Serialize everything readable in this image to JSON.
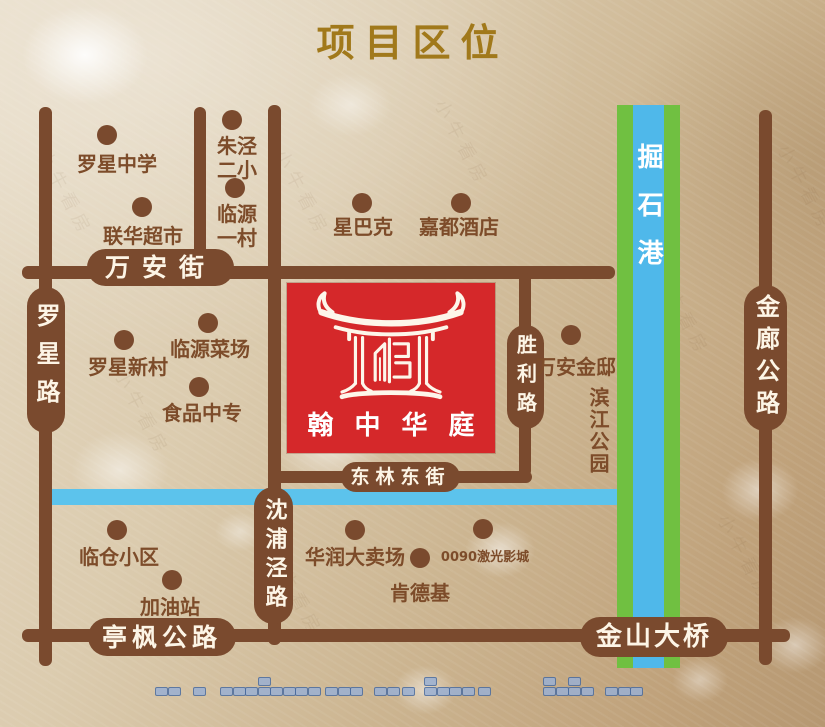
{
  "title": "项目区位",
  "colors": {
    "road": "#7a4a2e",
    "label_text": "#7d4c2a",
    "title_gold": "#a1791b",
    "capsule_text": "#fdf5e6",
    "red_block": "#d5282a",
    "river_green": "#70c041",
    "river_blue": "#4fb8ea",
    "canal_blue": "#5cc3ec",
    "dash_fill": "#9ab0d3",
    "dash_border": "#4a6ca0"
  },
  "project": {
    "name": "翰中华庭",
    "display": "翰中华庭",
    "block": {
      "x": 287,
      "y": 283,
      "w": 208,
      "h": 170
    }
  },
  "roads": [
    {
      "id": "wanan-street-line",
      "type": "h",
      "x": 22,
      "y": 266,
      "len": 593,
      "th": 13
    },
    {
      "id": "donglin-east-street-line",
      "type": "h",
      "x": 268,
      "y": 471,
      "len": 264,
      "th": 12
    },
    {
      "id": "tingfeng-jinshan-line",
      "type": "h",
      "x": 22,
      "y": 629,
      "len": 768,
      "th": 13
    },
    {
      "id": "luoxing-road-line",
      "type": "v",
      "x": 39,
      "y": 107,
      "len": 559,
      "th": 13
    },
    {
      "id": "north-branch-line",
      "type": "v",
      "x": 194,
      "y": 107,
      "len": 166,
      "th": 12
    },
    {
      "id": "shenpujing-road-line",
      "type": "v",
      "x": 268,
      "y": 105,
      "len": 540,
      "th": 13
    },
    {
      "id": "shengli-road-line",
      "type": "v",
      "x": 519,
      "y": 273,
      "len": 204,
      "th": 12
    },
    {
      "id": "jinlang-road-line",
      "type": "v",
      "x": 759,
      "y": 110,
      "len": 555,
      "th": 13
    }
  ],
  "road_labels": [
    {
      "id": "wanan-street",
      "text": "万安街",
      "dir": "h",
      "x": 87,
      "y": 249,
      "w": 147,
      "h": 37,
      "fs": 25,
      "ls": 12
    },
    {
      "id": "donglin-east-street",
      "text": "东林东街",
      "dir": "h",
      "x": 341,
      "y": 462,
      "w": 119,
      "h": 30,
      "fs": 19,
      "ls": 6
    },
    {
      "id": "tingfeng-highway",
      "text": "亭枫公路",
      "dir": "h",
      "x": 88,
      "y": 618,
      "w": 148,
      "h": 38,
      "fs": 25,
      "ls": 5
    },
    {
      "id": "jinshan-bridge",
      "text": "金山大桥",
      "dir": "h",
      "x": 580,
      "y": 617,
      "w": 148,
      "h": 40,
      "fs": 26,
      "ls": 3
    },
    {
      "id": "luoxing-road",
      "text": "罗星路",
      "dir": "v",
      "x": 27,
      "y": 287,
      "w": 38,
      "h": 146,
      "fs": 24,
      "ls": 14
    },
    {
      "id": "shenpujing-road",
      "text": "沈浦泾路",
      "dir": "v",
      "x": 254,
      "y": 487,
      "w": 39,
      "h": 137,
      "fs": 22,
      "ls": 7
    },
    {
      "id": "shengli-road",
      "text": "胜利路",
      "dir": "v",
      "x": 507,
      "y": 325,
      "w": 37,
      "h": 104,
      "fs": 20,
      "ls": 9
    },
    {
      "id": "jinlang-highway",
      "text": "金廊公路",
      "dir": "v",
      "x": 744,
      "y": 285,
      "w": 43,
      "h": 146,
      "fs": 24,
      "ls": 8
    }
  ],
  "rivers": {
    "vertical": {
      "name": "掘石港",
      "x": 617,
      "y": 105,
      "w": 63,
      "h": 563,
      "green_w": 16
    },
    "canal": {
      "x": 45,
      "y": 489,
      "w": 572,
      "h": 16
    }
  },
  "pois": [
    {
      "id": "luoxing-middle-school",
      "lines": [
        "罗星中学"
      ],
      "dot": [
        107,
        135
      ],
      "label": [
        117,
        164
      ],
      "fs": 20
    },
    {
      "id": "lianhua-supermarket",
      "lines": [
        "联华超市"
      ],
      "dot": [
        142,
        207
      ],
      "label": [
        143,
        236
      ],
      "fs": 20
    },
    {
      "id": "zhujing-no2-primary",
      "lines": [
        "朱泾",
        "二小"
      ],
      "dot": [
        232,
        120
      ],
      "label": [
        237,
        158
      ],
      "fs": 20
    },
    {
      "id": "linyuan-village-1",
      "lines": [
        "临源",
        "一村"
      ],
      "dot": [
        235,
        188
      ],
      "label": [
        237,
        226
      ],
      "fs": 20
    },
    {
      "id": "starbucks",
      "lines": [
        "星巴克"
      ],
      "dot": [
        362,
        203
      ],
      "label": [
        363,
        227
      ],
      "fs": 20
    },
    {
      "id": "jiadu-hotel",
      "lines": [
        "嘉都酒店"
      ],
      "dot": [
        461,
        203
      ],
      "label": [
        459,
        227
      ],
      "fs": 20
    },
    {
      "id": "linyuan-market",
      "lines": [
        "临源菜场"
      ],
      "dot": [
        208,
        323
      ],
      "label": [
        210,
        349
      ],
      "fs": 20
    },
    {
      "id": "luoxing-new-village",
      "lines": [
        "罗星新村"
      ],
      "dot": [
        124,
        340
      ],
      "label": [
        128,
        367
      ],
      "fs": 20
    },
    {
      "id": "food-vocational-school",
      "lines": [
        "食品中专"
      ],
      "dot": [
        199,
        387
      ],
      "label": [
        202,
        413
      ],
      "fs": 20
    },
    {
      "id": "wanan-jindi",
      "lines": [
        "万安金邸"
      ],
      "dot": [
        571,
        335
      ],
      "label": [
        576,
        367
      ],
      "fs": 20
    },
    {
      "id": "lincang-residence",
      "lines": [
        "临仓小区"
      ],
      "dot": [
        117,
        530
      ],
      "label": [
        119,
        557
      ],
      "fs": 20
    },
    {
      "id": "gas-station",
      "lines": [
        "加油站"
      ],
      "dot": [
        172,
        580
      ],
      "label": [
        170,
        607
      ],
      "fs": 20
    },
    {
      "id": "huarun-hypermarket",
      "lines": [
        "华润大卖场"
      ],
      "dot": [
        355,
        530
      ],
      "label": [
        355,
        557
      ],
      "fs": 20
    },
    {
      "id": "kfc",
      "lines": [
        "肯德基"
      ],
      "dot": [
        420,
        558
      ],
      "label": [
        420,
        593
      ],
      "fs": 20
    },
    {
      "id": "0090-laser-cinema",
      "lines": [
        "0090激光影城"
      ],
      "dot": [
        483,
        529
      ],
      "label": [
        485,
        558
      ],
      "fs": 13
    }
  ],
  "areas": [
    {
      "id": "binjiang-park",
      "text": "滨江公园",
      "center": [
        598,
        431
      ],
      "fs": 20,
      "vertical": true
    }
  ],
  "dashes": {
    "y": 687,
    "raised_dy": -10,
    "pitch": 12.5,
    "groups": [
      {
        "x": 155,
        "n": 2
      },
      {
        "x": 193,
        "n": 1
      },
      {
        "x": 220,
        "n": 8,
        "raised": [
          3
        ]
      },
      {
        "x": 325,
        "n": 3
      },
      {
        "x": 374,
        "n": 2
      },
      {
        "x": 402,
        "n": 1
      },
      {
        "x": 424,
        "n": 4,
        "raised": [
          0
        ]
      },
      {
        "x": 478,
        "n": 1
      },
      {
        "x": 543,
        "n": 4,
        "raised": [
          0,
          2
        ]
      },
      {
        "x": 605,
        "n": 3
      }
    ]
  },
  "watermark": {
    "text": "小牛看房",
    "spots": [
      [
        18,
        180
      ],
      [
        255,
        180
      ],
      [
        758,
        175
      ],
      [
        95,
        400
      ],
      [
        635,
        300
      ],
      [
        248,
        580
      ],
      [
        698,
        545
      ],
      [
        415,
        130
      ]
    ]
  }
}
